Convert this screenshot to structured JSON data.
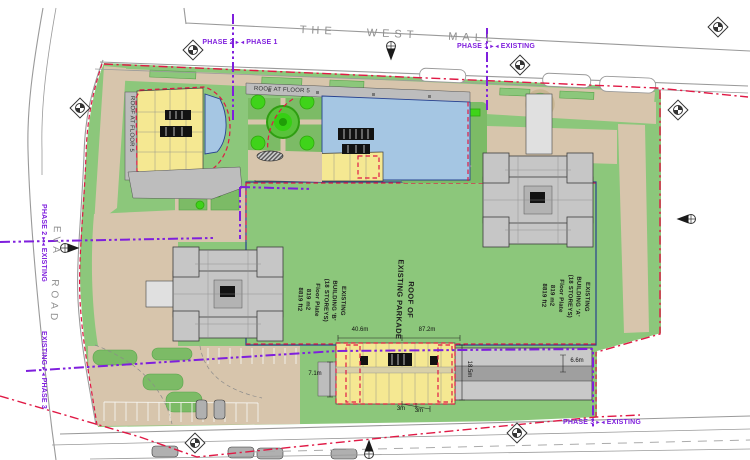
{
  "colors": {
    "site_green": "#8CC77B",
    "court_green": "#7CBB66",
    "bright_green": "#3FD31A",
    "tree_green": "#2FA90C",
    "tan": "#D7C5AC",
    "band_gray": "#BDBDBD",
    "building_gray": "#C6C6C6",
    "building_yellow": "#F5E892",
    "terrace_blue": "#A5C6E3",
    "red_line": "#E01945",
    "purple_line": "#7F1FDD",
    "navy": "#27418F",
    "road_gray": "#9A9A9A",
    "walk_gray": "#E0E0E0",
    "strip_dark": "#9F9F9F",
    "label_gray": "#8F8F8F",
    "ink": "#222222"
  },
  "roads": {
    "west_mall": "THE WEST MALL",
    "eva_road": "EVA ROAD"
  },
  "icons": {
    "phase_divider_left": "▸",
    "phase_divider_right": "◂"
  },
  "phase_labels": {
    "top_west": {
      "left": "PHASE 2",
      "right": "PHASE 1"
    },
    "top_east": {
      "left": "PHASE 1",
      "right": "EXISTING"
    },
    "west_upper": {
      "left": "PHASE 2",
      "right": "EXISTING"
    },
    "west_lower": {
      "left": "EXISTING",
      "right": "PHASE 3"
    },
    "bottom_east": {
      "left": "PHASE 3",
      "right": "EXISTING"
    }
  },
  "buildings": {
    "building_a": {
      "label": "EXISTING\nBUILDING 'A'\n(18 STOREYS)\nFloor Plate\n819 m2\n8819 ft2"
    },
    "building_b": {
      "label": "EXISTING\nBUILDING 'B'\n(18 STOREYS)\nFloor Plate\n819 m2\n8819 ft2"
    },
    "parkade": {
      "label": "ROOF OF\nEXISTING PARKADE"
    },
    "roof_band": {
      "label": "ROOF AT FLOOR 5"
    },
    "roof_west": {
      "label": "ROOF AT FLOOR 5"
    }
  },
  "dimensions": {
    "d1": "40.6m",
    "d2": "87.2m",
    "d3": "7.1m",
    "d4": "18.5m",
    "d5": "3m",
    "d6": "3m",
    "d7": "6.6m"
  }
}
